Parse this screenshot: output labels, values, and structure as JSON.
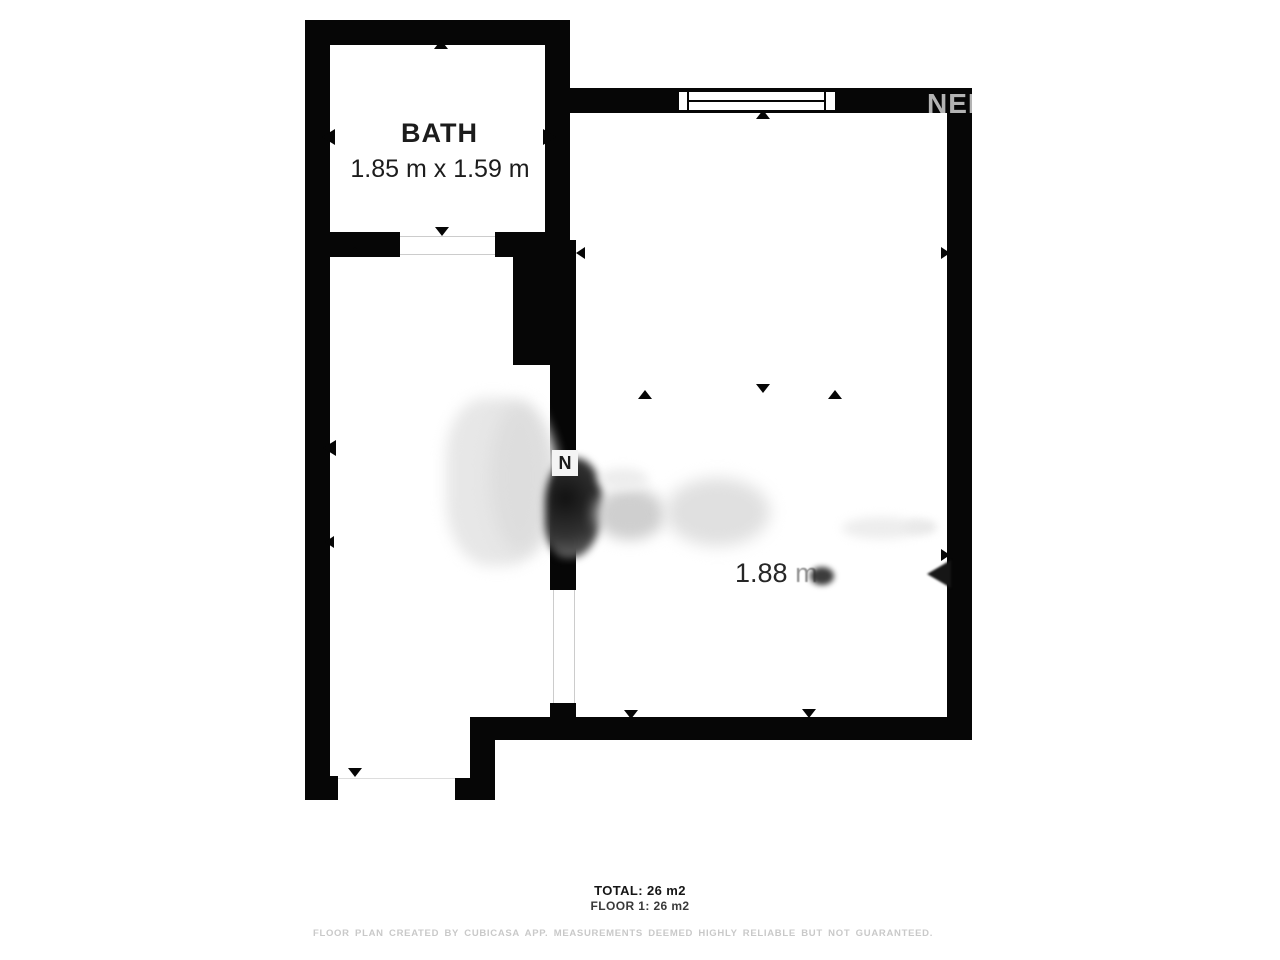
{
  "watermark": {
    "text": "NEF"
  },
  "rooms": {
    "bath": {
      "name": "BATH",
      "dimensions": "1.85 m x 1.59 m"
    },
    "main": {
      "width_value": "1.88",
      "width_unit": "m"
    }
  },
  "north_marker": {
    "letter": "N"
  },
  "summary": {
    "total": "TOTAL: 26 m2",
    "floor": "FLOOR 1: 26 m2"
  },
  "disclaimer": "FLOOR PLAN CREATED BY CUBICASA APP. MEASUREMENTS DEEMED HIGHLY RELIABLE BUT NOT GUARANTEED.",
  "colors": {
    "wall": "#060606",
    "text": "#1c1c1c",
    "watermark": "#b3b3b3",
    "disclaimer": "#c9c9c9"
  }
}
